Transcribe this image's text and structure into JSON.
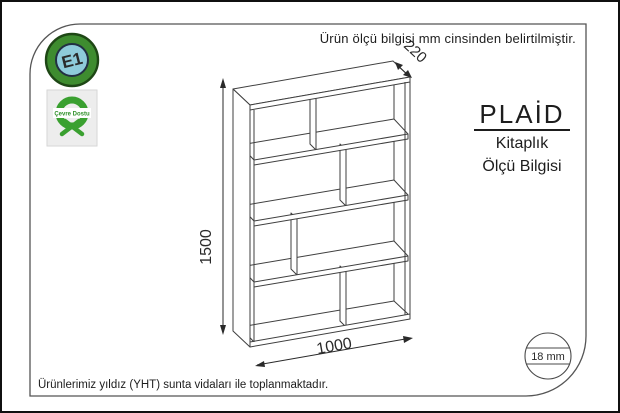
{
  "top_note": "Ürün ölçü bilgisi mm cinsinden belirtilmiştir.",
  "badges": {
    "e1_label": "E1",
    "eco_label": "Çevre Dostu"
  },
  "title_block": {
    "brand": "PLAİD",
    "category": "Kitaplık",
    "sheet": "Ölçü Bilgisi"
  },
  "dimensions": {
    "height_mm": "1500",
    "width_mm": "1000",
    "depth_mm": "220",
    "panel_thickness": "18 mm"
  },
  "bottom_note": "Ürünlerimiz yıldız (YHT) sunta vidaları ile toplanmaktadır.",
  "colors": {
    "e1_ring": "#3E8C2F",
    "e1_center": "#8ECBDA",
    "eco_green": "#3aa030",
    "drawing_line": "#3f3f3f",
    "frame_line": "#555555"
  }
}
